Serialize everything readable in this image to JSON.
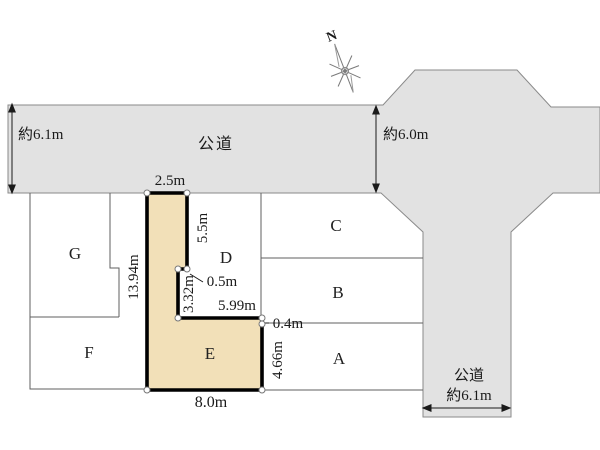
{
  "diagram": {
    "compass": {
      "north": "N"
    },
    "roads": {
      "top": {
        "name": "公道",
        "width": "約6.1m"
      },
      "cross": {
        "width": "約6.0m"
      },
      "right": {
        "name": "公道",
        "width": "約6.1m"
      }
    },
    "plots": {
      "A": "A",
      "B": "B",
      "C": "C",
      "D": "D",
      "E": "E",
      "F": "F",
      "G": "G"
    },
    "dimensions": {
      "e_top": "2.5m",
      "e_right_upper": "5.5m",
      "e_left": "13.94m",
      "e_step": "0.5m",
      "e_right_mid": "3.32m",
      "e_inner_top": "5.99m",
      "e_offset": "0.4m",
      "e_right_lower": "4.66m",
      "e_bottom": "8.0m"
    },
    "colors": {
      "road_fill": "#e2e2e2",
      "road_stroke": "#8a8a8a",
      "plot_line": "#5f5f5f",
      "highlight_fill": "#f2e0b8",
      "highlight_stroke": "#000000"
    }
  }
}
